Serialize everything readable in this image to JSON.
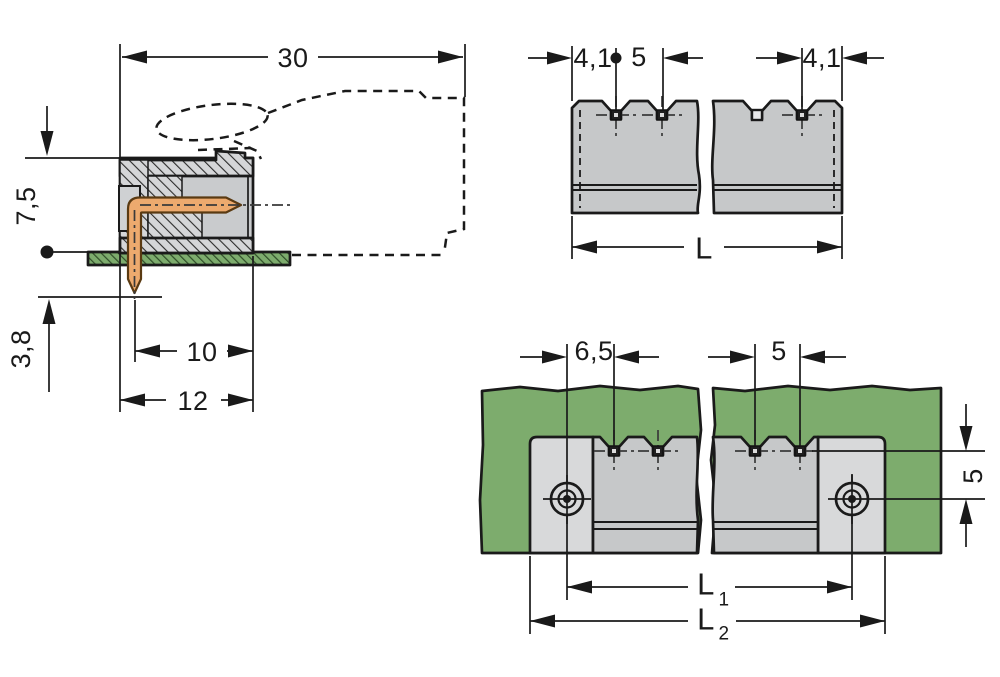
{
  "side": {
    "d30": "30",
    "d75": "7,5",
    "d38": "3,8",
    "d10": "10",
    "d12": "12"
  },
  "top": {
    "d41_left": "4,1",
    "d5_pitch": "5",
    "d41_right": "4,1",
    "dL": "L"
  },
  "pcb": {
    "d65": "6,5",
    "d5_pitch": "5",
    "d5_vertical": "5",
    "dL1_base": "L",
    "dL1_sub": "1",
    "dL2_base": "L",
    "dL2_sub": "2"
  },
  "colors": {
    "line": "#1a1a1a",
    "body_gray": "#c6c8c9",
    "cavity_gray": "#c9cbcd",
    "flange_gray": "#d8d9da",
    "hatch_bg_gray": "#d5d6d8",
    "board_green": "#7dac6d",
    "board_hatch_green": "#2f4e28",
    "pin_copper": "#edaa6e",
    "pin_outline": "#5a3a12"
  }
}
